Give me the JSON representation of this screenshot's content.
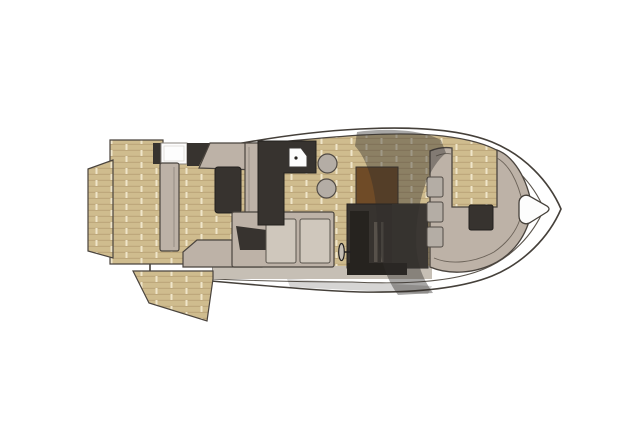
{
  "diagram": {
    "kind": "yacht-floorplan-top-view",
    "orientation": "bow-right",
    "components": [
      "swim-platform",
      "aft-teak-deck",
      "beach-platform-flap",
      "aft-sunpad-lounge",
      "deck-hatch",
      "galley-counter",
      "galley-sink",
      "bar-stools",
      "cockpit-settee",
      "helm-dash",
      "helm-console",
      "steering-wheel",
      "wraparound-windshield",
      "bow-lounge",
      "bow-table",
      "bow-backrest-cushions",
      "anchor-locker-hatch"
    ]
  },
  "palette": {
    "outline": "#45403a",
    "hull_fill": "#ffffff",
    "inner_line": "#5a544c",
    "teak_base": "#cbb78a",
    "teak_grain": "#b9a478",
    "teak_light": "#dcc99d",
    "teak_seam": "#efe5c9",
    "upholstery": "#bdb2a7",
    "upholstery_edge": "#4a443e",
    "cushion": "#cfc7bc",
    "dark": "#37332f",
    "dark_deep": "#26231f",
    "helm_brown": "#6f4b27",
    "stool": "#b4ada5",
    "hatch_white": "#fdfdfd",
    "hatch_edge": "#8a857f",
    "base_band": "#c6bfb5",
    "glass": "rgba(48,45,42,0.42)",
    "glass_tail": "rgba(48,45,42,0.20)",
    "slit": "#57514a",
    "wheel": "#c7c0b6"
  }
}
